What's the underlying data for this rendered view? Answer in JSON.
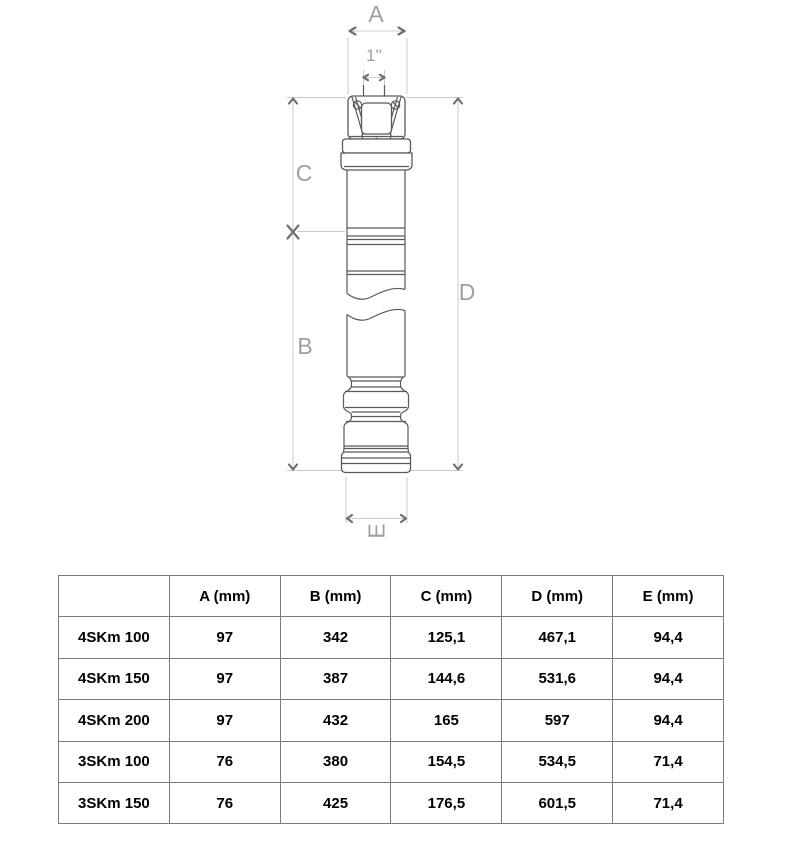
{
  "diagram": {
    "labels": {
      "a": "A",
      "port": "1''",
      "c": "C",
      "b": "B",
      "d": "D",
      "e": "E"
    }
  },
  "table": {
    "headers": [
      "",
      "A (mm)",
      "B (mm)",
      "C (mm)",
      "D (mm)",
      "E (mm)"
    ],
    "rows": [
      {
        "model": "4SKm 100",
        "a": "97",
        "b": "342",
        "c": "125,1",
        "d": "467,1",
        "e": "94,4"
      },
      {
        "model": "4SKm 150",
        "a": "97",
        "b": "387",
        "c": "144,6",
        "d": "531,6",
        "e": "94,4"
      },
      {
        "model": "4SKm 200",
        "a": "97",
        "b": "432",
        "c": "165",
        "d": "597",
        "e": "94,4"
      },
      {
        "model": "3SKm 100",
        "a": "76",
        "b": "380",
        "c": "154,5",
        "d": "534,5",
        "e": "71,4"
      },
      {
        "model": "3SKm 150",
        "a": "76",
        "b": "425",
        "c": "176,5",
        "d": "601,5",
        "e": "71,4"
      }
    ]
  },
  "colors": {
    "table_border": "#7b7b7b",
    "dimension_line": "#c9cbcd",
    "dimension_text": "#9ca0a4",
    "arrow": "#6d7175",
    "pump_outline": "#565a5e"
  }
}
